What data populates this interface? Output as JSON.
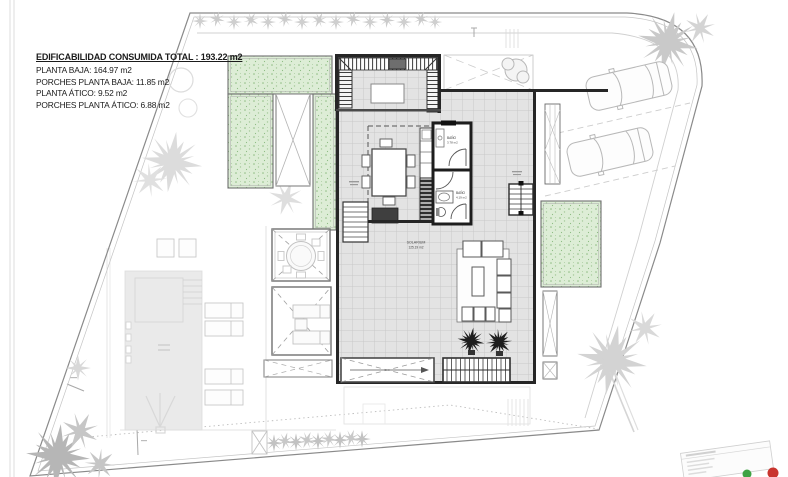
{
  "legend": {
    "total_label": "EDIFICABILIDAD CONSUMIDA TOTAL : 193.22 m2",
    "items": [
      "PLANTA BAJA: 164.97 m2",
      "PORCHES PLANTA BAJA: 11.85 m2",
      "PLANTA ÁTICO: 9.52 m2",
      "PORCHES PLANTA ÁTICO: 6.88 m2"
    ]
  },
  "plan_labels": {
    "solarium": {
      "name": "SOLARIUM",
      "area": "125.19 m2"
    },
    "bath_upper": {
      "name": "BAÑO",
      "area": "3.78 m2"
    },
    "bath_lower": {
      "name": "BAÑO",
      "area": "4.19 m2"
    }
  },
  "colors": {
    "garden_green": "#ddedd6",
    "tile_gray": "#e3e3e3",
    "wall_dark": "#262626",
    "vegetation_gray": "#cfcfcf",
    "stamp_green": "#3fa344",
    "stamp_red": "#c9342e"
  }
}
